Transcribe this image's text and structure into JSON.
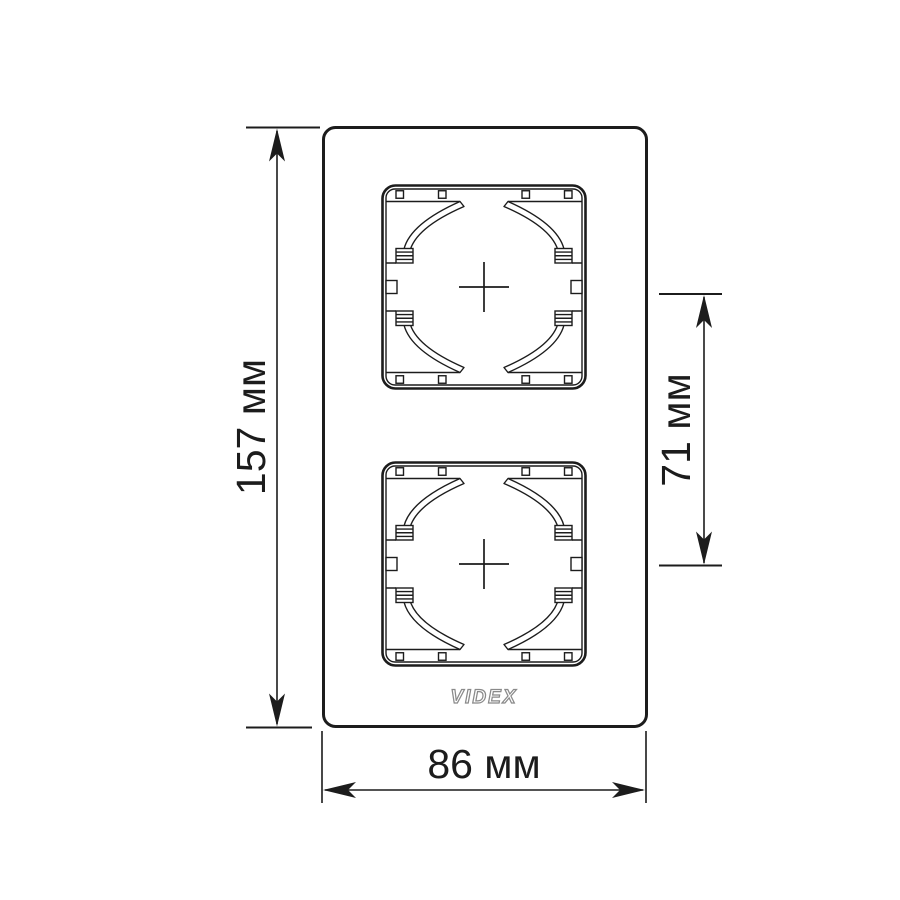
{
  "drawing": {
    "brand_logo": "VIDEX",
    "dimensions": {
      "overall_height": {
        "label": "157 мм",
        "value_mm": 157,
        "unit": "мм"
      },
      "overall_width": {
        "label": "86 мм",
        "value_mm": 86,
        "unit": "мм"
      },
      "center_spacing": {
        "label": "71 мм",
        "value_mm": 71,
        "unit": "мм"
      }
    }
  },
  "colors": {
    "line": "#1c1c1c",
    "logo_outline": "#8a8a8a",
    "background": "#ffffff"
  }
}
